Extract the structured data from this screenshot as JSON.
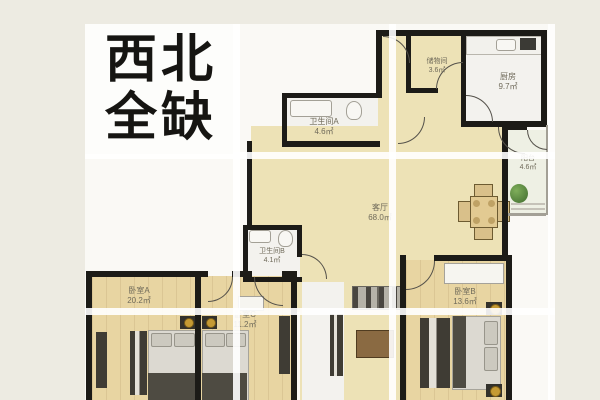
{
  "title": {
    "line1": "西北",
    "line2": "全缺"
  },
  "rooms": [
    {
      "name": "储物间",
      "area": "3.6㎡"
    },
    {
      "name": "厨房",
      "area": "9.7㎡"
    },
    {
      "name": "卫生间A",
      "area": "4.6㎡"
    },
    {
      "name": "阳台",
      "area": "4.6㎡"
    },
    {
      "name": "客厅",
      "area": "68.0㎡"
    },
    {
      "name": "卫生间B",
      "area": "4.1㎡"
    },
    {
      "name": "卧室A",
      "area": "20.2㎡"
    },
    {
      "name": "卧室C",
      "area": "11.2㎡"
    },
    {
      "name": "卧室B",
      "area": "13.6㎡"
    }
  ],
  "colors": {
    "page_bg": "#edebe2",
    "plan_bg": "#faf9f5",
    "room_tan": "#ede2b6",
    "bedroom_wood": "#e8d5a2",
    "wall": "#1c1b17",
    "grid_line": "#ffffff",
    "title_text": "#161512",
    "lamp_gold": "#c59a33",
    "plant_green": "#4c7a3d"
  }
}
